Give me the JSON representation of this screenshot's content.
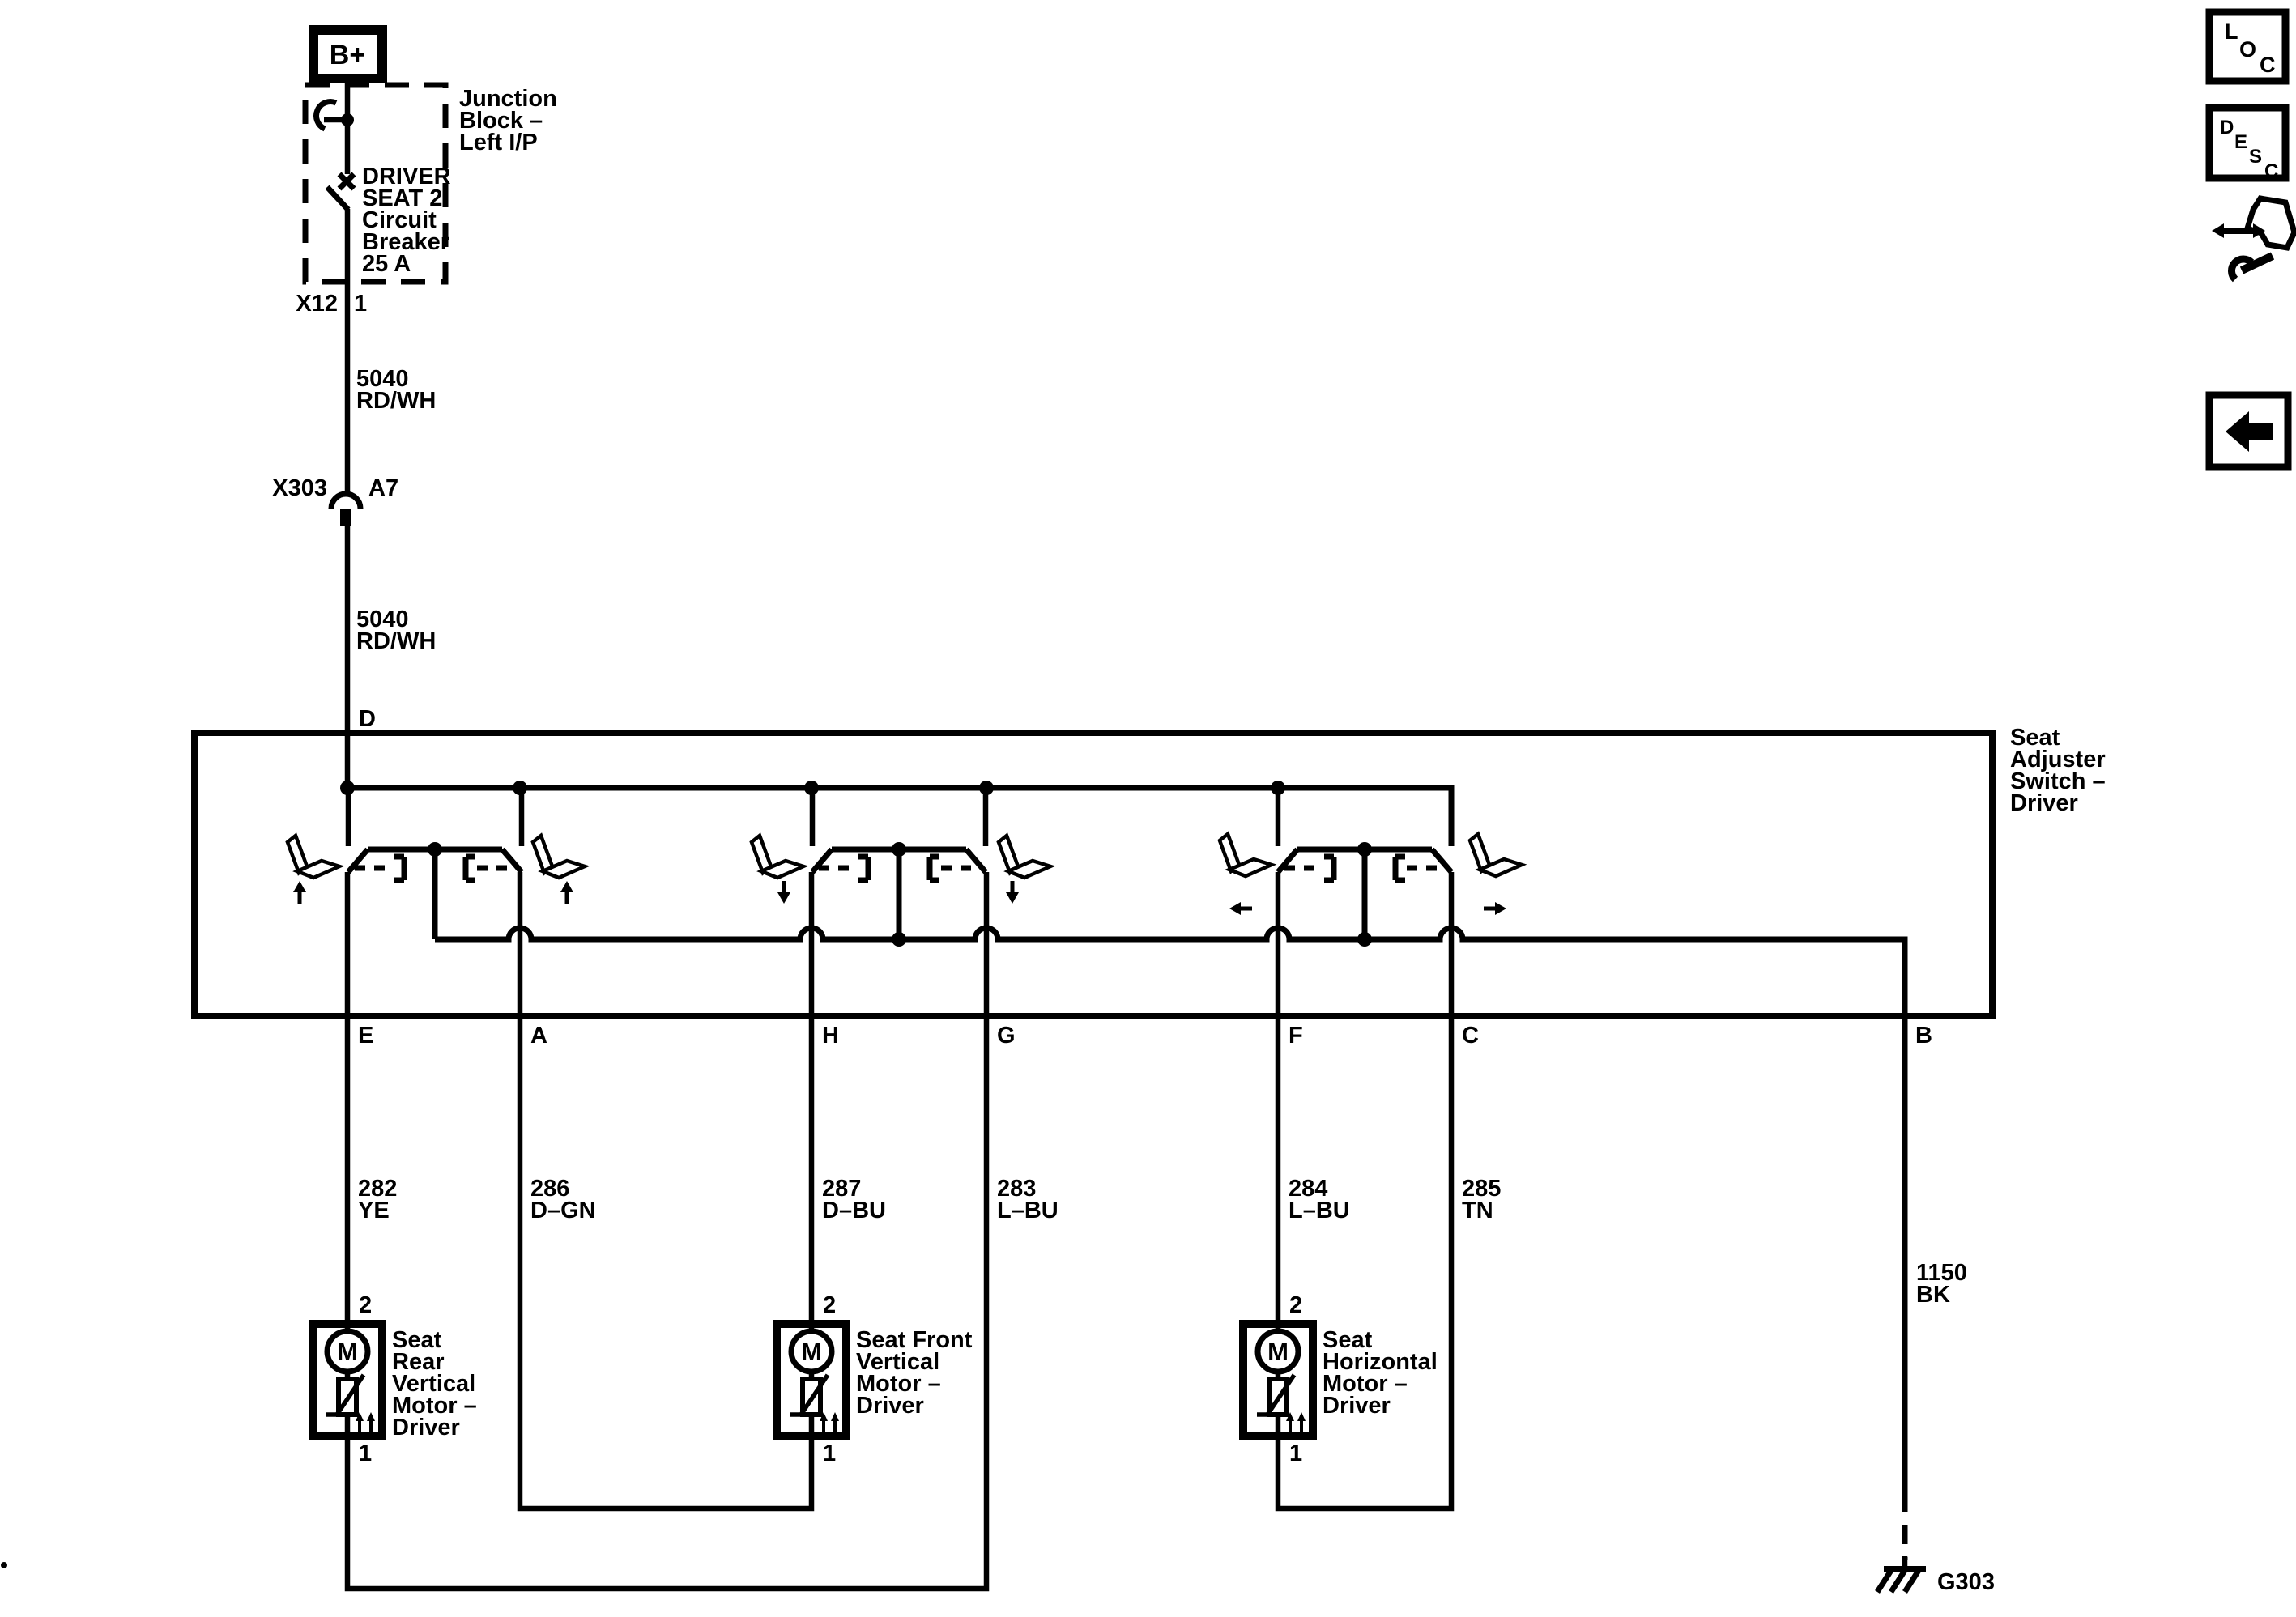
{
  "power": {
    "b_plus": "B+",
    "junction_block": [
      "Junction",
      "Block –",
      "Left I/P"
    ],
    "breaker": [
      "DRIVER",
      "SEAT 2",
      "Circuit",
      "Breaker",
      "25 A"
    ],
    "x12": "X12",
    "x12_pin": "1",
    "wire_5040": [
      "5040",
      "RD/WH"
    ],
    "x303": "X303",
    "x303_pin": "A7"
  },
  "switch": {
    "pin_d": "D",
    "label": [
      "Seat",
      "Adjuster",
      "Switch –",
      "Driver"
    ],
    "pins": {
      "e": "E",
      "a": "A",
      "h": "H",
      "g": "G",
      "f": "F",
      "c": "C",
      "b": "B"
    }
  },
  "wires": {
    "e": [
      "282",
      "YE"
    ],
    "a": [
      "286",
      "D–GN"
    ],
    "h": [
      "287",
      "D–BU"
    ],
    "g": [
      "283",
      "L–BU"
    ],
    "f": [
      "284",
      "L–BU"
    ],
    "c": [
      "285",
      "TN"
    ],
    "b": [
      "1150",
      "BK"
    ]
  },
  "motors": {
    "m": "M",
    "pin_top": "2",
    "pin_bottom": "1",
    "rear": [
      "Seat",
      "Rear",
      "Vertical",
      "Motor –",
      "Driver"
    ],
    "front": [
      "Seat Front",
      "Vertical",
      "Motor –",
      "Driver"
    ],
    "horizontal": [
      "Seat",
      "Horizontal",
      "Motor –",
      "Driver"
    ]
  },
  "ground": {
    "label": "G303"
  },
  "toolbar": {
    "loc": [
      "L",
      "O",
      "C"
    ],
    "desc": [
      "D",
      "E",
      "S",
      "C"
    ]
  },
  "colors": {
    "ink": "#000000",
    "paper": "#ffffff"
  }
}
